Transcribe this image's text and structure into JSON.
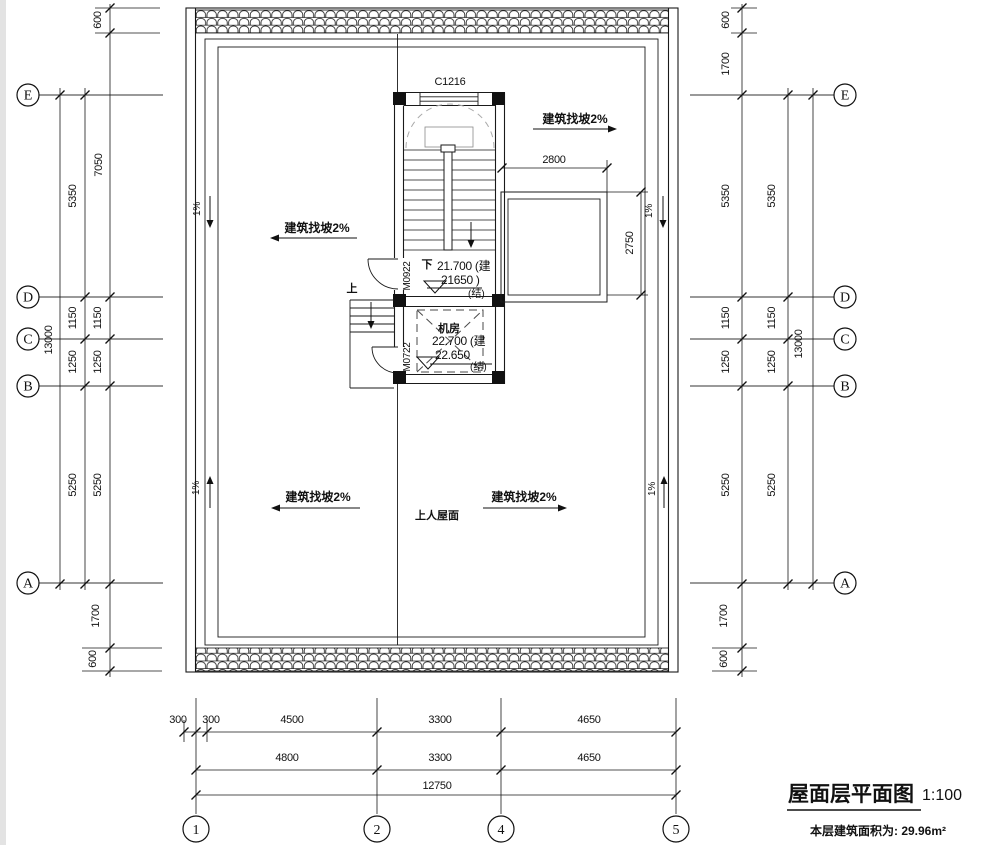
{
  "title_block": {
    "title": "屋面层平面图",
    "scale": "1:100",
    "area": "本层建筑面积为: 29.96m²"
  },
  "grid": {
    "rows": [
      "E",
      "D",
      "C",
      "B",
      "A"
    ],
    "cols": [
      "1",
      "2",
      "4",
      "5"
    ]
  },
  "dim_left": {
    "total": "13000",
    "mid": [
      "5350",
      "1150",
      "1250",
      "5250"
    ],
    "inner": [
      "600",
      "7050",
      "1150",
      "1250",
      "5250",
      "1700",
      "600"
    ]
  },
  "dim_right": {
    "total": "13000",
    "mid": [
      "5350",
      "1150",
      "1250",
      "5250"
    ],
    "inner": [
      "600",
      "1700",
      "5350",
      "1150",
      "1250",
      "5250",
      "1700",
      "600"
    ]
  },
  "dim_bottom": {
    "row1": [
      "300",
      "300",
      "4500",
      "3300",
      "4650"
    ],
    "row2": [
      "4800",
      "3300",
      "4650"
    ],
    "total": "12750"
  },
  "dim_detail": {
    "stair_bay": "2800",
    "lower_roof": "2750"
  },
  "labels": {
    "window": "C1216",
    "stair_door": "M0922",
    "machine_door": "M0722",
    "machine_room": "机房",
    "roof_access": "上人屋面",
    "slope2": "建筑找坡2%",
    "slope1": "1%",
    "down": "下",
    "up": "上"
  },
  "levels": {
    "stair_arch": "21.700 (建",
    "stair_struct": "21650 )",
    "stair_struct_tag": "(结)",
    "machine_arch": "22.700 (建",
    "machine_struct": "22.650",
    "machine_struct_tag": "(结)"
  }
}
